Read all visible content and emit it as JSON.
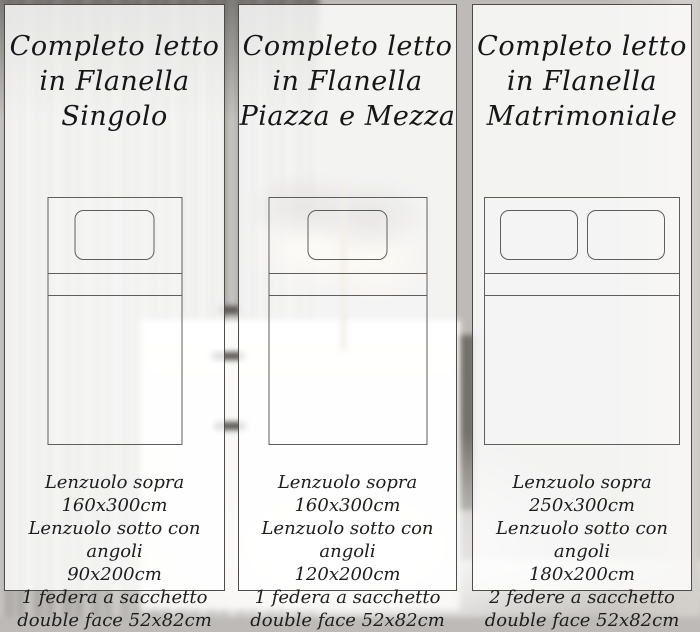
{
  "colors": {
    "panel_fill": "rgba(255,255,255,0.82)",
    "panel_border": "#4c4c4a",
    "diagram_line": "#5e5e5c",
    "text": "#161616"
  },
  "panels": [
    {
      "title_lines": [
        "Completo letto",
        "in Flanella",
        "Singolo"
      ],
      "bed": {
        "size_name": "singolo",
        "pillows": 1
      },
      "spec_lines": [
        "Lenzuolo sopra 160x300cm",
        "Lenzuolo sotto con angoli",
        "90x200cm",
        "1 federa a sacchetto",
        "double face 52x82cm"
      ]
    },
    {
      "title_lines": [
        "Completo letto",
        "in Flanella",
        "Piazza e Mezza"
      ],
      "bed": {
        "size_name": "piazza-e-mezza",
        "pillows": 1
      },
      "spec_lines": [
        "Lenzuolo sopra 160x300cm",
        "Lenzuolo sotto con angoli",
        "120x200cm",
        "1 federa a sacchetto",
        "double face 52x82cm"
      ]
    },
    {
      "title_lines": [
        "Completo letto",
        "in Flanella",
        "Matrimoniale"
      ],
      "bed": {
        "size_name": "matrimoniale",
        "pillows": 2
      },
      "spec_lines": [
        "Lenzuolo sopra 250x300cm",
        "Lenzuolo sotto con angoli",
        "180x200cm",
        "2 federe a sacchetto",
        "double face 52x82cm"
      ]
    }
  ]
}
